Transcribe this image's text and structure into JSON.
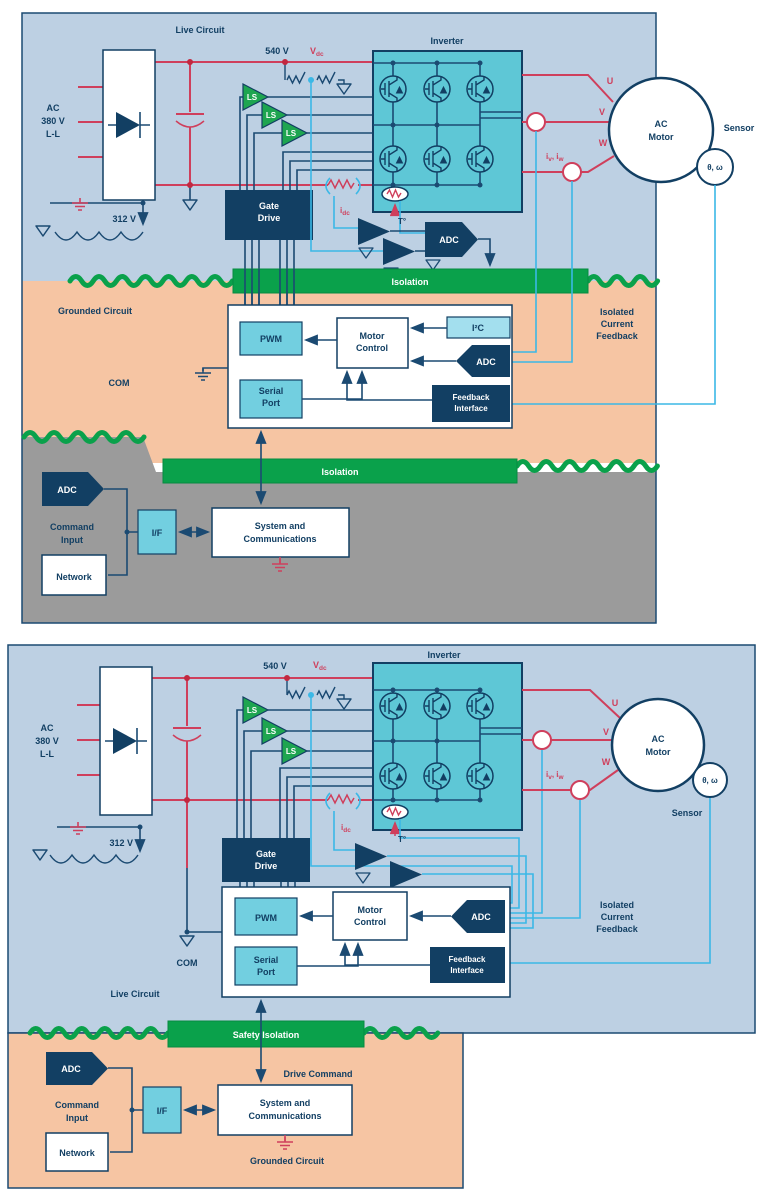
{
  "title": "Motor drive isolation architecture diagrams",
  "colors": {
    "background": "#ffffff",
    "live_region_blue": "#bdd0e3",
    "grounded_region_orange": "#f6c5a3",
    "chassis_region_gray": "#9b9b9b",
    "inverter_fill": "#5ec7d6",
    "navy": "#123f63",
    "wire_navy": "#1b4a72",
    "power_red": "#cf3f5c",
    "signal_cyan": "#3bb8e6",
    "isolation_green": "#0aa14b",
    "ls_green": "#1ea550",
    "teal_box": "#72cfe0",
    "i2c_box": "#a3dfee"
  },
  "labels": {
    "live_circuit": "Live Circuit",
    "grounded_circuit": "Grounded Circuit",
    "inverter": "Inverter",
    "ac_input": [
      "AC",
      "380 V",
      "L-L"
    ],
    "dc_bus_voltage": "540 V",
    "ripple_voltage": "312 V",
    "vdc_main": "V",
    "vdc_sub": "dc",
    "idc_main": "i",
    "idc_sub": "dc",
    "phase_u": "U",
    "phase_v": "V",
    "phase_w": "W",
    "iv_iw": [
      "i",
      "v",
      ", i",
      "w"
    ],
    "ls": "LS",
    "gate_drive": [
      "Gate",
      "Drive"
    ],
    "temp": "T°",
    "adc": "ADC",
    "isolation": "Isolation",
    "safety_isolation": "Safety Isolation",
    "ac_motor": [
      "AC",
      "Motor"
    ],
    "sensor": "Sensor",
    "theta_omega": "θ, ω",
    "com": "COM",
    "pwm": "PWM",
    "motor_control": [
      "Motor",
      "Control"
    ],
    "i2c": "I²C",
    "serial_port": [
      "Serial",
      "Port"
    ],
    "feedback_interface": [
      "Feedback",
      "Interface"
    ],
    "isolated_current_feedback": [
      "Isolated",
      "Current",
      "Feedback"
    ],
    "command_input": [
      "Command",
      "Input"
    ],
    "network": "Network",
    "interface": "I/F",
    "system_comms": [
      "System and",
      "Communications"
    ],
    "drive_command": "Drive Command"
  }
}
